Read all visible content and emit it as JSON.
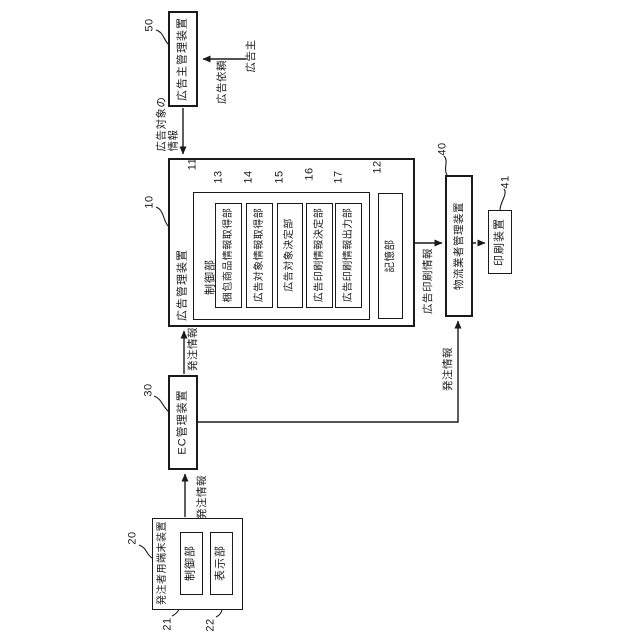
{
  "diagram": {
    "colors": {
      "background": "#ffffff",
      "line": "#1a1a1a",
      "text": "#1a1a1a"
    },
    "boxes": {
      "advertiser_mgmt": {
        "ref": "50",
        "label": "広告主管理装置"
      },
      "ad_mgmt": {
        "ref": "10",
        "label": "広告管理装置"
      },
      "control_unit": {
        "ref": "11",
        "label": "制御部"
      },
      "packed_item_info_acq": {
        "ref": "13",
        "label": "梱包商品情報取得部"
      },
      "ad_target_info_acq": {
        "ref": "14",
        "label": "広告対象情報取得部"
      },
      "ad_target_decision": {
        "ref": "15",
        "label": "広告対象決定部"
      },
      "ad_print_info_decision": {
        "ref": "16",
        "label": "広告印刷情報決定部"
      },
      "ad_print_info_output": {
        "ref": "17",
        "label": "広告印刷情報出力部"
      },
      "storage_unit": {
        "ref": "12",
        "label": "記憶部"
      },
      "logistics_mgmt": {
        "ref": "40",
        "label": "物流業者管理装置"
      },
      "printing_device": {
        "ref": "41",
        "label": "印刷装置"
      },
      "ec_mgmt": {
        "ref": "30",
        "label": "EC管理装置"
      },
      "orderer_terminal": {
        "ref": "20",
        "label": "発注者用端末装置"
      },
      "terminal_control": {
        "ref": "21",
        "label": "制御部"
      },
      "terminal_display": {
        "ref": "22",
        "label": "表示部"
      }
    },
    "actors": {
      "advertiser": "広告主"
    },
    "edges": {
      "ad_request": "広告依頼",
      "ad_target_info": "広告対象の\n情報",
      "order_info_ec_to_admgmt": "発注情報",
      "order_info_terminal_to_ec": "発注情報",
      "order_info_ec_to_logistics": "発注情報",
      "ad_print_info": "広告印刷情報"
    }
  }
}
